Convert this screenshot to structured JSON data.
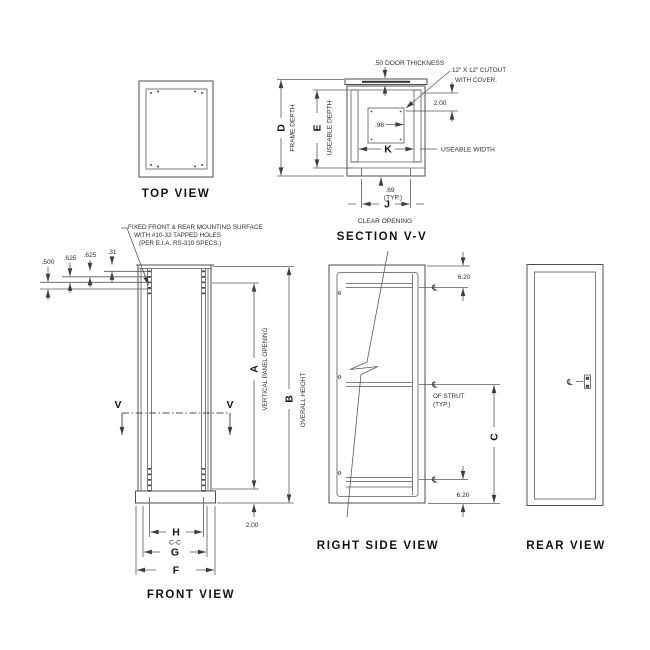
{
  "views": {
    "top": {
      "title": "TOP VIEW"
    },
    "section": {
      "title": "SECTION V-V",
      "door_thickness_note": ".50 DOOR THICKNESS",
      "cutout_note_line1": "12\" X 12\" CUTOUT",
      "cutout_note_line2": "WITH COVER.",
      "dim_cutout_offset": "2.00",
      "dim_98": ".98",
      "letter_k": "K",
      "useable_width_label": "USEABLE WIDTH",
      "dim_69": ".69",
      "typ_label": "(TYP.)",
      "letter_j": "J",
      "clear_opening_label": "CLEAR OPENING",
      "letter_d": "D",
      "frame_depth_label": "FRAME DEPTH",
      "letter_e": "E",
      "useable_depth_label": "USEABLE DEPTH"
    },
    "front": {
      "title": "FRONT VIEW",
      "mounting_note_line1": "FIXED FRONT & REAR MOUNTING SURFACE",
      "mounting_note_line2": "WITH #10-32 TAPPED HOLES",
      "mounting_note_line3": "(PER E.I.A. RS-310 SPECS.)",
      "dim_500": ".500",
      "dim_625a": ".625",
      "dim_625b": ".625",
      "dim_31": ".31",
      "letter_v": "V",
      "letter_a": "A",
      "vertical_panel_opening_label": "VERTICAL PANEL OPENING",
      "letter_b": "B",
      "overall_height_label": "OVERALL HEIGHT",
      "dim_200": "2.00",
      "letter_h": "H",
      "cc_label": "C-C",
      "letter_g": "G",
      "letter_f": "F"
    },
    "right_side": {
      "title": "RIGHT SIDE VIEW",
      "dim_620_top": "6.20",
      "dim_620_bottom": "6.20",
      "letter_c": "C",
      "centerline_symbol": "℄",
      "strut_note_line1": "OF STRUT",
      "strut_note_line2": "(TYP.)"
    },
    "rear": {
      "title": "REAR VIEW",
      "centerline_symbol": "℄"
    }
  }
}
